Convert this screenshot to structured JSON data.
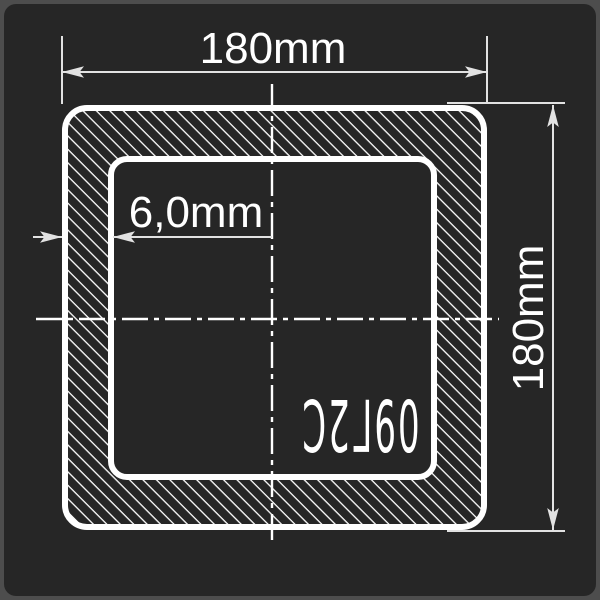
{
  "colors": {
    "frame": "#4d4d4d",
    "panel": "#262626",
    "line": "#ffffff",
    "dim": "#e2e2e2",
    "text": "#ffffff"
  },
  "drawing": {
    "outer_width_label": "180mm",
    "outer_height_label": "180mm",
    "wall_thickness_label": "6,0mm",
    "steel_grade_label": "09Г2С"
  }
}
